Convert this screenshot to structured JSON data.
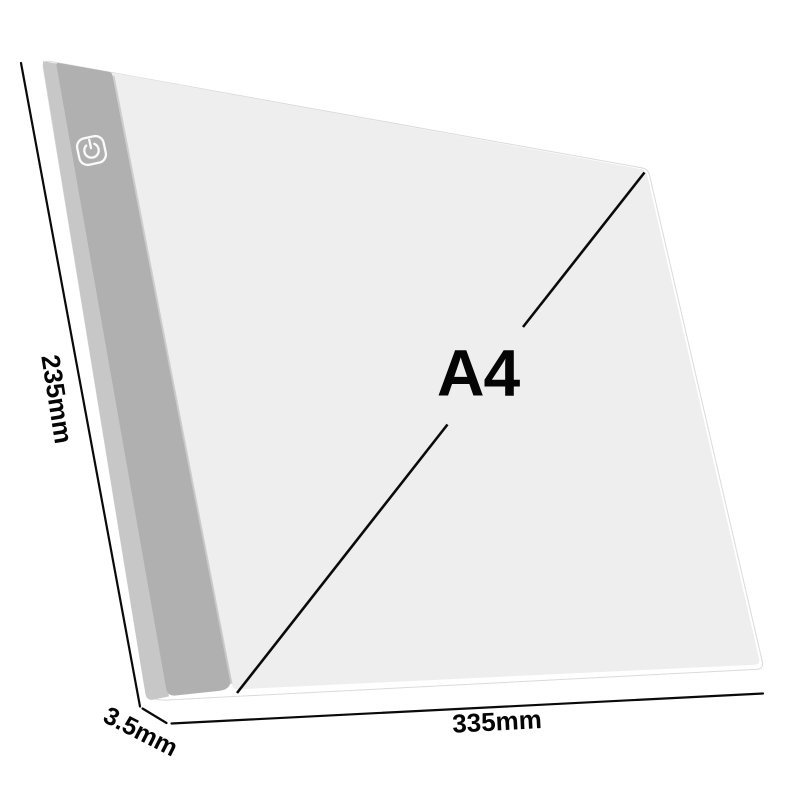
{
  "diagram": {
    "size_label": "A4",
    "dim_left": "235mm",
    "dim_thickness": "3.5mm",
    "dim_bottom": "335mm",
    "power_icon_glyph": "⏻"
  },
  "colors": {
    "background": "#ffffff",
    "pad_edge": "#ffffff",
    "pad_edge_stroke": "#dadada",
    "bezel": "#b0b0b0",
    "bezel_side": "#c7c7c7",
    "surface": "#eeeeef",
    "bevel_highlight": "#cacaca",
    "line": "#0a0a0a",
    "icon_stroke": "#fafafa"
  }
}
